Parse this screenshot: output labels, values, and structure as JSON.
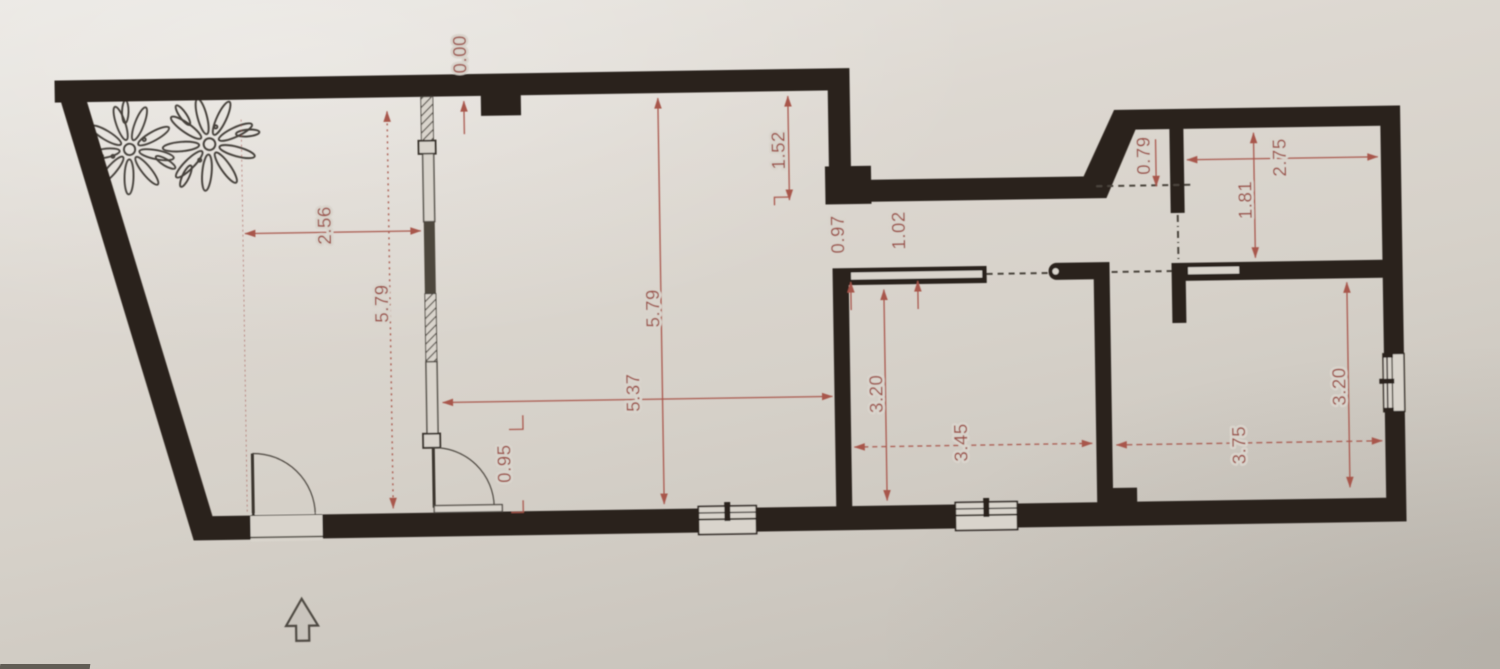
{
  "drawing": {
    "type": "architectural-floor-plan",
    "description": "photographed floor plan with red dimension annotations in meters"
  },
  "labels": {
    "datum": "0.00",
    "recess_depth": "1.52",
    "terrace_width": "2.56",
    "terrace_length": "5.79",
    "living_length": "5.79",
    "living_width": "5.37",
    "partition_door_width": "0.95",
    "hall_segment_a": "0.97",
    "hall_segment_b": "1.02",
    "middle_room_depth": "3.20",
    "middle_room_width": "3.45",
    "passage_width": "0.79",
    "upper_right_room_depth": "1.81",
    "upper_right_room_width": "2.75",
    "right_room_depth": "3.20",
    "right_room_width": "3.75"
  },
  "icons": {
    "north_arrow": "north-arrow-icon",
    "plant": "plant-sketch-icon"
  },
  "colors": {
    "paper": "#d9d4cc",
    "wall": "#29221b",
    "dimension_red": "#9c5047",
    "line_gray": "#4b453d"
  }
}
